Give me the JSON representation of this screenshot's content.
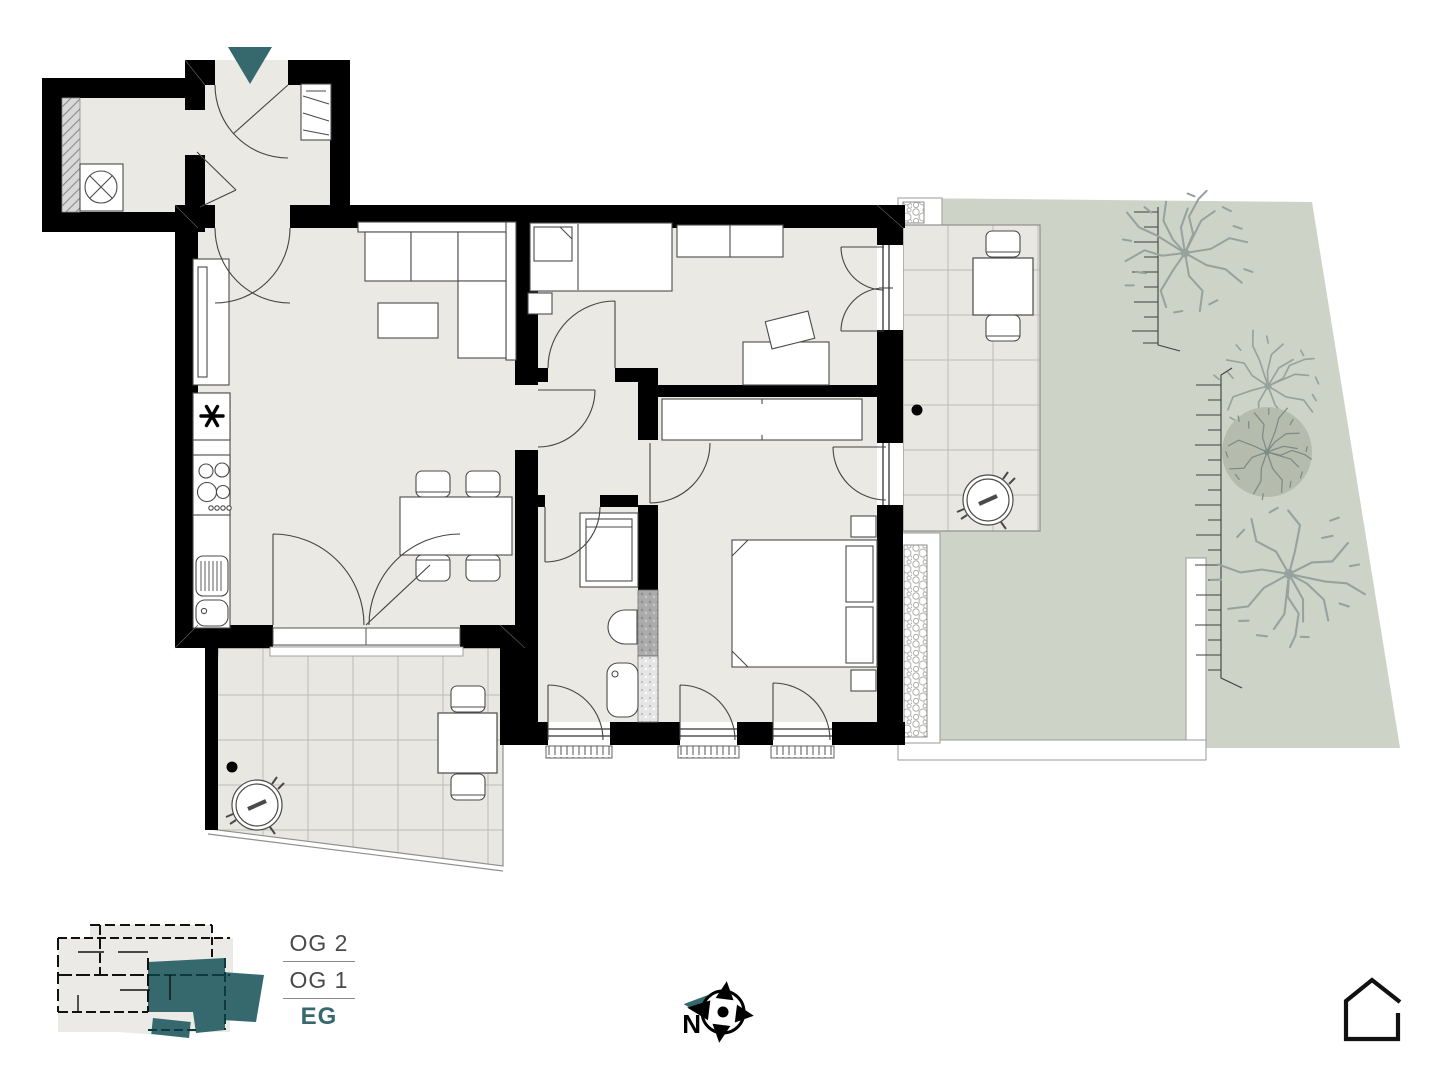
{
  "legend": {
    "floors": [
      {
        "label": "OG 2",
        "active": false
      },
      {
        "label": "OG 1",
        "active": false
      },
      {
        "label": "EG",
        "active": true
      }
    ]
  },
  "compass": {
    "north_label": "N"
  },
  "colors": {
    "accent_teal": "#35696E",
    "garden_green": "#CDD3C6",
    "interior_floor": "#EAE9E4",
    "terrace_tile": "#E8E7E2",
    "wall_black": "#000000",
    "tree_gray": "#97A19E",
    "tree_crown_fill": "#B5BCAD",
    "legend_text_gray": "#4A4A4A"
  },
  "icons": {
    "entry_arrow": "entrance-direction-arrow",
    "compass_rose": "north-compass-rose",
    "house_outline": "project-home-icon"
  }
}
